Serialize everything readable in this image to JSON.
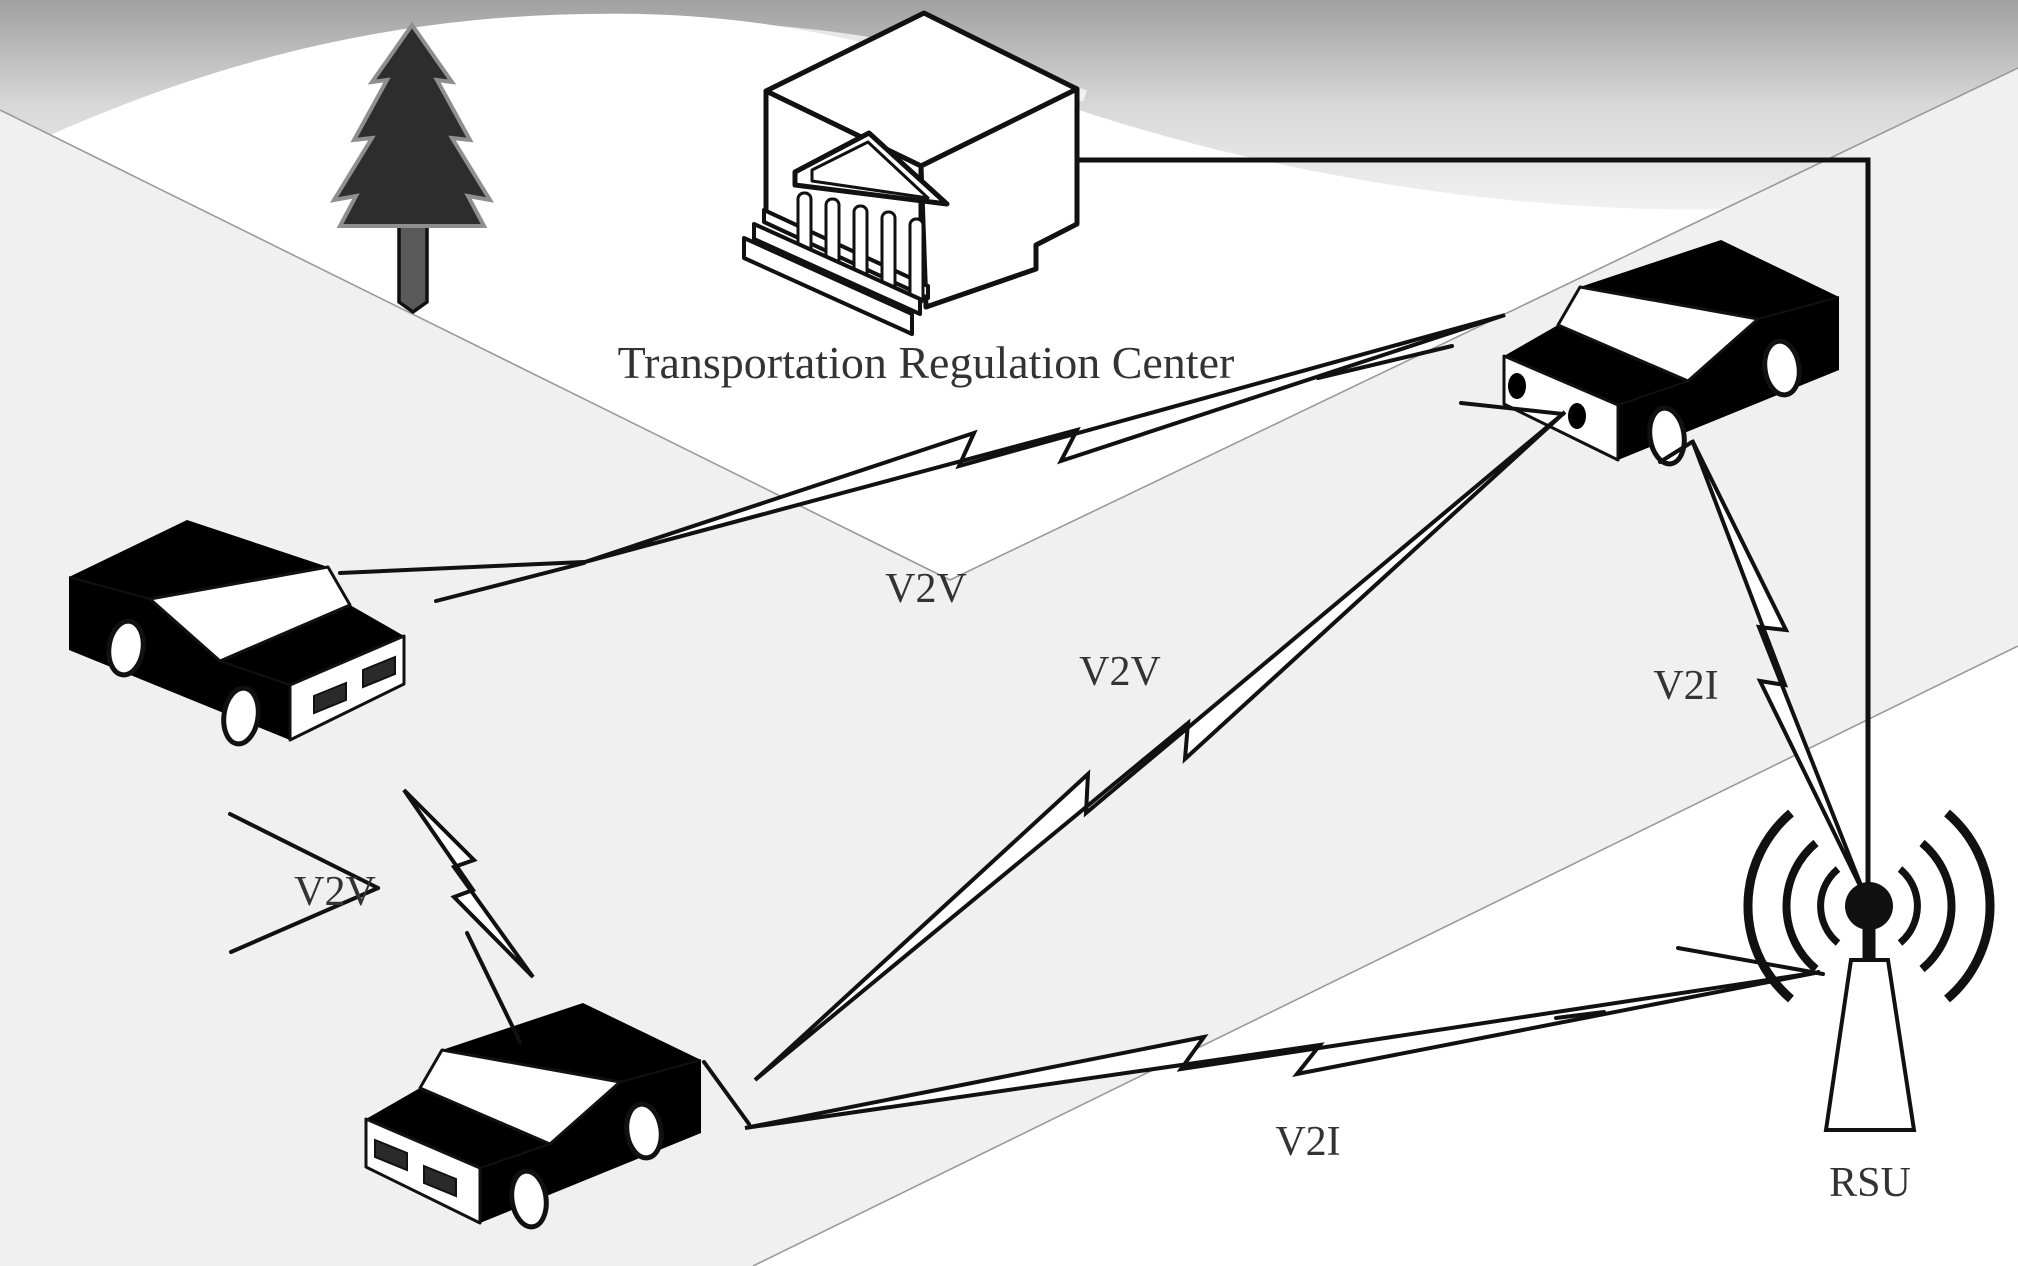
{
  "diagram": {
    "title": "V2V / V2I vehicular network schematic",
    "center": {
      "label": "Transportation Regulation Center"
    },
    "rsu": {
      "label": "RSU"
    },
    "links": {
      "v2v_left_gray": {
        "label": "V2V"
      },
      "v2v_bottom_gray": {
        "label": "V2V"
      },
      "v2v_left_bottom": {
        "label": "V2V"
      },
      "v2i_gray_rsu": {
        "label": "V2I"
      },
      "v2i_bottom_rsu": {
        "label": "V2I"
      }
    },
    "icons": {
      "tree": "pine-tree-icon",
      "building": "regulation-center-building-icon",
      "car_left": "black-car-icon",
      "car_bottom": "black-car-icon",
      "car_gray": "gray-car-icon",
      "antenna": "rsu-antenna-icon",
      "bolts": "lightning-link-icon"
    },
    "colors": {
      "car_black": "#242424",
      "car_gray": "#7f7f7f",
      "ground_gray": "#f0f0f0",
      "label_text": "#333333",
      "outline": "#111111"
    }
  }
}
